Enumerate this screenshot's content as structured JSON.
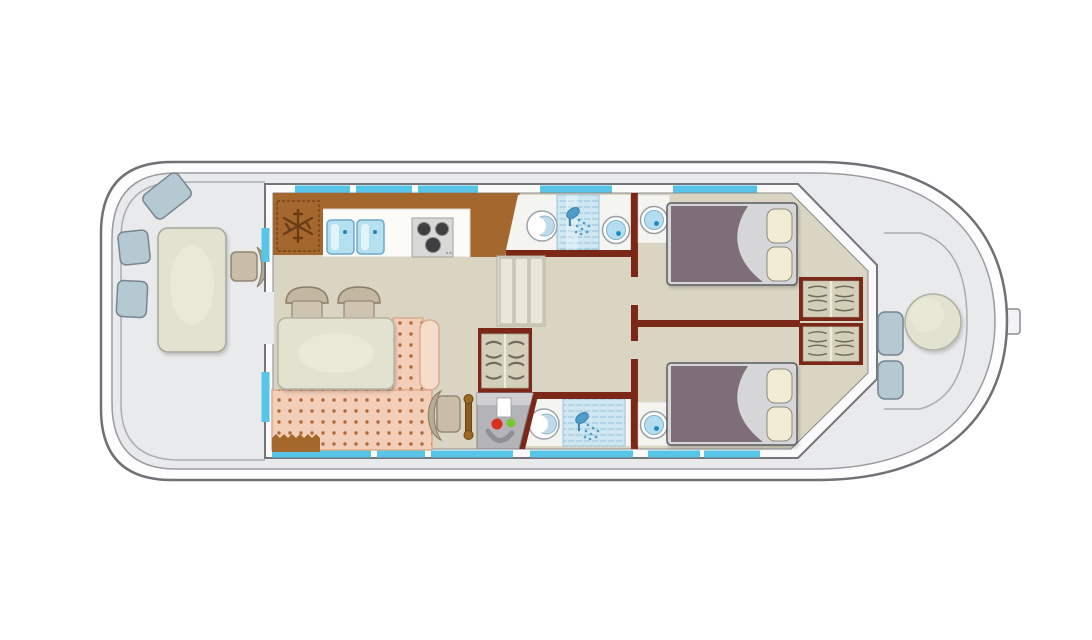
{
  "diagram": {
    "type": "houseboat-floor-plan",
    "label": "Houseboat deck floor plan, bow at left and stern at right",
    "orientation": "bow-left-stern-right"
  },
  "colors": {
    "background": "#ffffff",
    "hull_fill": "#fdfdfe",
    "hull_stroke": "#707076",
    "deck_fill": "#e9eaec",
    "cabin_wall_fill": "#fafafa",
    "floor_fill": "#d9d5c2",
    "bathroom_floor": "#f4f4f1",
    "window_blue": "#56c5e8",
    "interior_wall_maroon": "#7b2818",
    "counter_brown": "#a4682e",
    "worktop_white": "#fbfbf8",
    "sink_blue": "#b5e0ef",
    "stove_gray": "#d8d8d6",
    "burner_dark": "#3f3f42",
    "table_sage": "#e2e2d0",
    "chair_tan": "#c9bda9",
    "sofa_salmon": "#f3cfb9",
    "sofa_dot": "#b06838",
    "bed_duvet": "#7e6e79",
    "bed_sheet": "#d6d6d8",
    "pillow_cream": "#f2ecd2",
    "cushion_blue_gray": "#b4c9d2",
    "wardrobe_fill": "#d3cfb8",
    "shower_blue": "#cfe7f2",
    "basin_blue": "#b5ddef",
    "step_fill": "#e9e6da",
    "console_gray": "#b3b3b8",
    "indicator_red": "#d83020",
    "indicator_green": "#78c832"
  },
  "icons": [
    "snowflake-fridge-icon",
    "shower-head-icon",
    "stove-burner-icon",
    "steering-wheel-icon",
    "hanger-wardrobe-icon"
  ],
  "inventory": {
    "bow_deck": {
      "tables": 1,
      "seat_cushions": 3,
      "chairs": 1
    },
    "galley": {
      "fridges": 1,
      "sinks": 2,
      "stove_burners": 3
    },
    "salon": {
      "dining_tables": 1,
      "chairs": 2,
      "sofa_sections": 2
    },
    "helm_station": {
      "seats": 1,
      "steering_wheels": 1,
      "consoles": 1
    },
    "bathrooms": {
      "toilets": 2,
      "showers": 2,
      "washbasins": 1
    },
    "cabins": {
      "double_beds": 2,
      "washbasins": 2,
      "wardrobes": 2
    },
    "companionway": {
      "step_flights": 1,
      "wardrobes": 1
    },
    "stern_deck": {
      "tables": 1,
      "seat_cushions": 2
    }
  }
}
